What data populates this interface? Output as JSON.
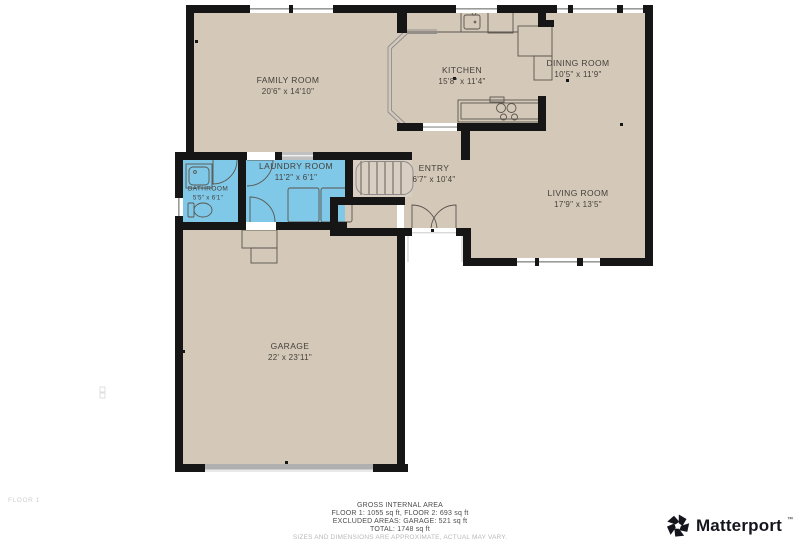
{
  "floorplan": {
    "colors": {
      "floor": "#d4c8b9",
      "highlight": "#7fc8e8",
      "wall": "#161616",
      "fixture_line": "#5a544d",
      "window_line": "#9a9a9a"
    },
    "floor_label": "FLOOR 1",
    "rooms": [
      {
        "id": "family-room",
        "name": "FAMILY ROOM",
        "dims": "20'6\" x 14'10\""
      },
      {
        "id": "kitchen",
        "name": "KITCHEN",
        "dims": "15'8\" x 11'4\""
      },
      {
        "id": "dining-room",
        "name": "DINING ROOM",
        "dims": "10'5\" x 11'9\""
      },
      {
        "id": "laundry-room",
        "name": "LAUNDRY ROOM",
        "dims": "11'2\" x 6'1\""
      },
      {
        "id": "bathroom",
        "name": "BATHROOM",
        "dims": "5'5\" x 6'1\""
      },
      {
        "id": "entry",
        "name": "ENTRY",
        "dims": "6'7\" x 10'4\""
      },
      {
        "id": "living-room",
        "name": "LIVING ROOM",
        "dims": "17'9\" x 13'5\""
      },
      {
        "id": "garage",
        "name": "GARAGE",
        "dims": "22' x 23'11\""
      }
    ]
  },
  "footer": {
    "area_summary": {
      "title": "GROSS INTERNAL AREA",
      "line1": "FLOOR 1: 1055 sq ft, FLOOR 2: 693 sq ft",
      "line2": "EXCLUDED AREAS: GARAGE: 521 sq ft",
      "line3": "TOTAL: 1748 sq ft",
      "disclaimer": "SIZES AND DIMENSIONS ARE APPROXIMATE, ACTUAL MAY VARY."
    },
    "brand": {
      "name": "Matterport",
      "trademark": "™"
    }
  }
}
